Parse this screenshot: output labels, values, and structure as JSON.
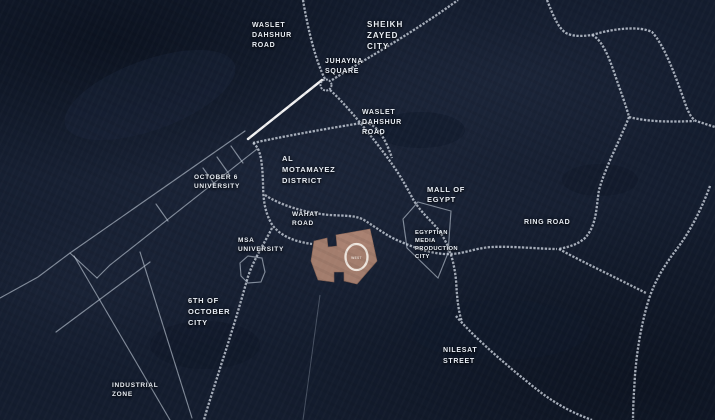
{
  "colors": {
    "background": "#141d2f",
    "road": "#c3cad6",
    "road_highlight": "#ffffff",
    "site_fill": "#a8806f",
    "label_text": "#e9eef5",
    "logo_ring": "#f2ebe4"
  },
  "site": {
    "marker": "o-west-ring-logo",
    "logo_text": "WEST"
  },
  "labels": {
    "waslet_dahshur_north": {
      "lines": [
        "WASLET",
        "DAHSHUR",
        "ROAD"
      ]
    },
    "sheikh_zayed_city": {
      "lines": [
        "SHEIKH",
        "ZAYED",
        "CITY"
      ]
    },
    "juhayna_square": {
      "lines": [
        "JUHAYNA",
        "SQUARE"
      ]
    },
    "waslet_dahshur_mid": {
      "lines": [
        "WASLET",
        "DAHSHUR",
        "ROAD"
      ]
    },
    "al_motamayez_district": {
      "lines": [
        "AL",
        "MOTAMAYEZ",
        "DISTRICT"
      ]
    },
    "october_6_university": {
      "lines": [
        "OCTOBER 6",
        "UNIVERSITY"
      ]
    },
    "mall_of_egypt": {
      "lines": [
        "MALL OF",
        "EGYPT"
      ]
    },
    "wahat_road": {
      "lines": [
        "WAHAT",
        "ROAD"
      ]
    },
    "ring_road": {
      "lines": [
        "RING ROAD"
      ]
    },
    "msa_university": {
      "lines": [
        "MSA",
        "UNIVERSITY"
      ]
    },
    "egyptian_media_production_city": {
      "lines": [
        "EGYPTIAN",
        "MEDIA",
        "PRODUCTION",
        "CITY"
      ]
    },
    "sixth_of_october_city": {
      "lines": [
        "6TH OF",
        "OCTOBER",
        "CITY"
      ]
    },
    "nilesat_street": {
      "lines": [
        "NILESAT",
        "STREET"
      ]
    },
    "industrial_zone": {
      "lines": [
        "INDUSTRIAL",
        "ZONE"
      ]
    }
  }
}
